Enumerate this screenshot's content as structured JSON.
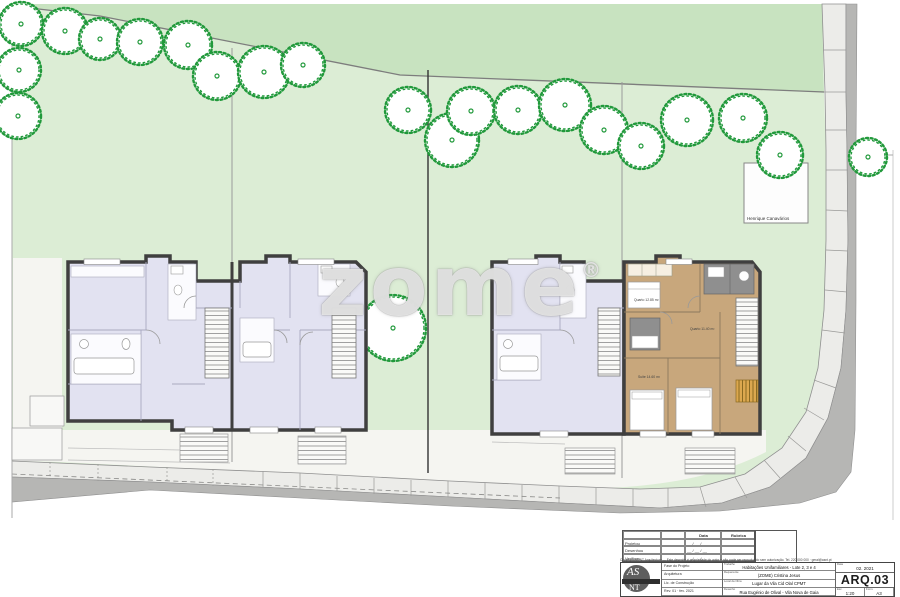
{
  "site": {
    "colors": {
      "green_light": "#dcedd5",
      "green_dark": "#c8e3c0",
      "tree_green": "#21993b",
      "lavender": "#e2e2f1",
      "wood_tan": "#c8a77c",
      "wall": "#3f3f3f",
      "road": "#b6b6b4",
      "sidewalk": "#ecece9"
    },
    "trees": [
      [
        21,
        24,
        22
      ],
      [
        65,
        31,
        23
      ],
      [
        100,
        39,
        21
      ],
      [
        140,
        42,
        23
      ],
      [
        188,
        45,
        24
      ],
      [
        217,
        76,
        24
      ],
      [
        264,
        72,
        26
      ],
      [
        303,
        65,
        22
      ],
      [
        19,
        70,
        22
      ],
      [
        18,
        116,
        23
      ],
      [
        408,
        110,
        23
      ],
      [
        452,
        140,
        27
      ],
      [
        471,
        111,
        24
      ],
      [
        518,
        110,
        24
      ],
      [
        565,
        105,
        26
      ],
      [
        604,
        130,
        24
      ],
      [
        641,
        146,
        23
      ],
      [
        687,
        120,
        26
      ],
      [
        743,
        118,
        24
      ],
      [
        780,
        155,
        23
      ],
      [
        868,
        157,
        19
      ],
      [
        393,
        328,
        33
      ]
    ],
    "neighbor_label": "Henrique Canavários",
    "room_labels": [
      "Quarto 12.85 m²",
      "Quarto 11.40 m²",
      "Suite 14.60 m²"
    ]
  },
  "watermark": {
    "text": "zome",
    "reg": "®"
  },
  "title_block": {
    "revisions": {
      "col_date": "Data",
      "col_signature": "Rubrica",
      "rows": [
        {
          "label": "Projetou",
          "date": "__ / __ / __"
        },
        {
          "label": "Desenhou",
          "date": "__ / __ / __"
        },
        {
          "label": "Verificou",
          "date": "__ / __ / __"
        }
      ]
    },
    "microtext": "Copyright AS·NT Arquitectura — Este desenho é propriedade do autor e não pode ser reproduzido sem autorização. Tel. 220 000 000 · geral@asnt.pt",
    "logo": {
      "top": "AS",
      "bottom": "NT"
    },
    "info_rows": [
      "Fase do Projeto",
      "Arquitetura",
      "Lic. de Construção",
      "Rev. 01 · fev. 2021"
    ],
    "fields": [
      {
        "label": "Trabalho",
        "value": "Habitações Unifamiliares - Lote 2, 3 e 4"
      },
      {
        "label": "Requerente",
        "value": "(ZOME) Cristina Jesus"
      },
      {
        "label": "Local da Obra",
        "value": "Lugar da Vila Cid Olal CPMT"
      },
      {
        "label": "Desenho",
        "value": "Rua Eugénio de Olival - Vila Nova de Gaia"
      }
    ],
    "date_label": "Data",
    "date": "02. 2021",
    "number_label": "N.º",
    "drawing_number": "ARQ.03",
    "scale_label": "Esc.",
    "scale": "1:20",
    "format_label": "Form.",
    "format": "A3"
  }
}
